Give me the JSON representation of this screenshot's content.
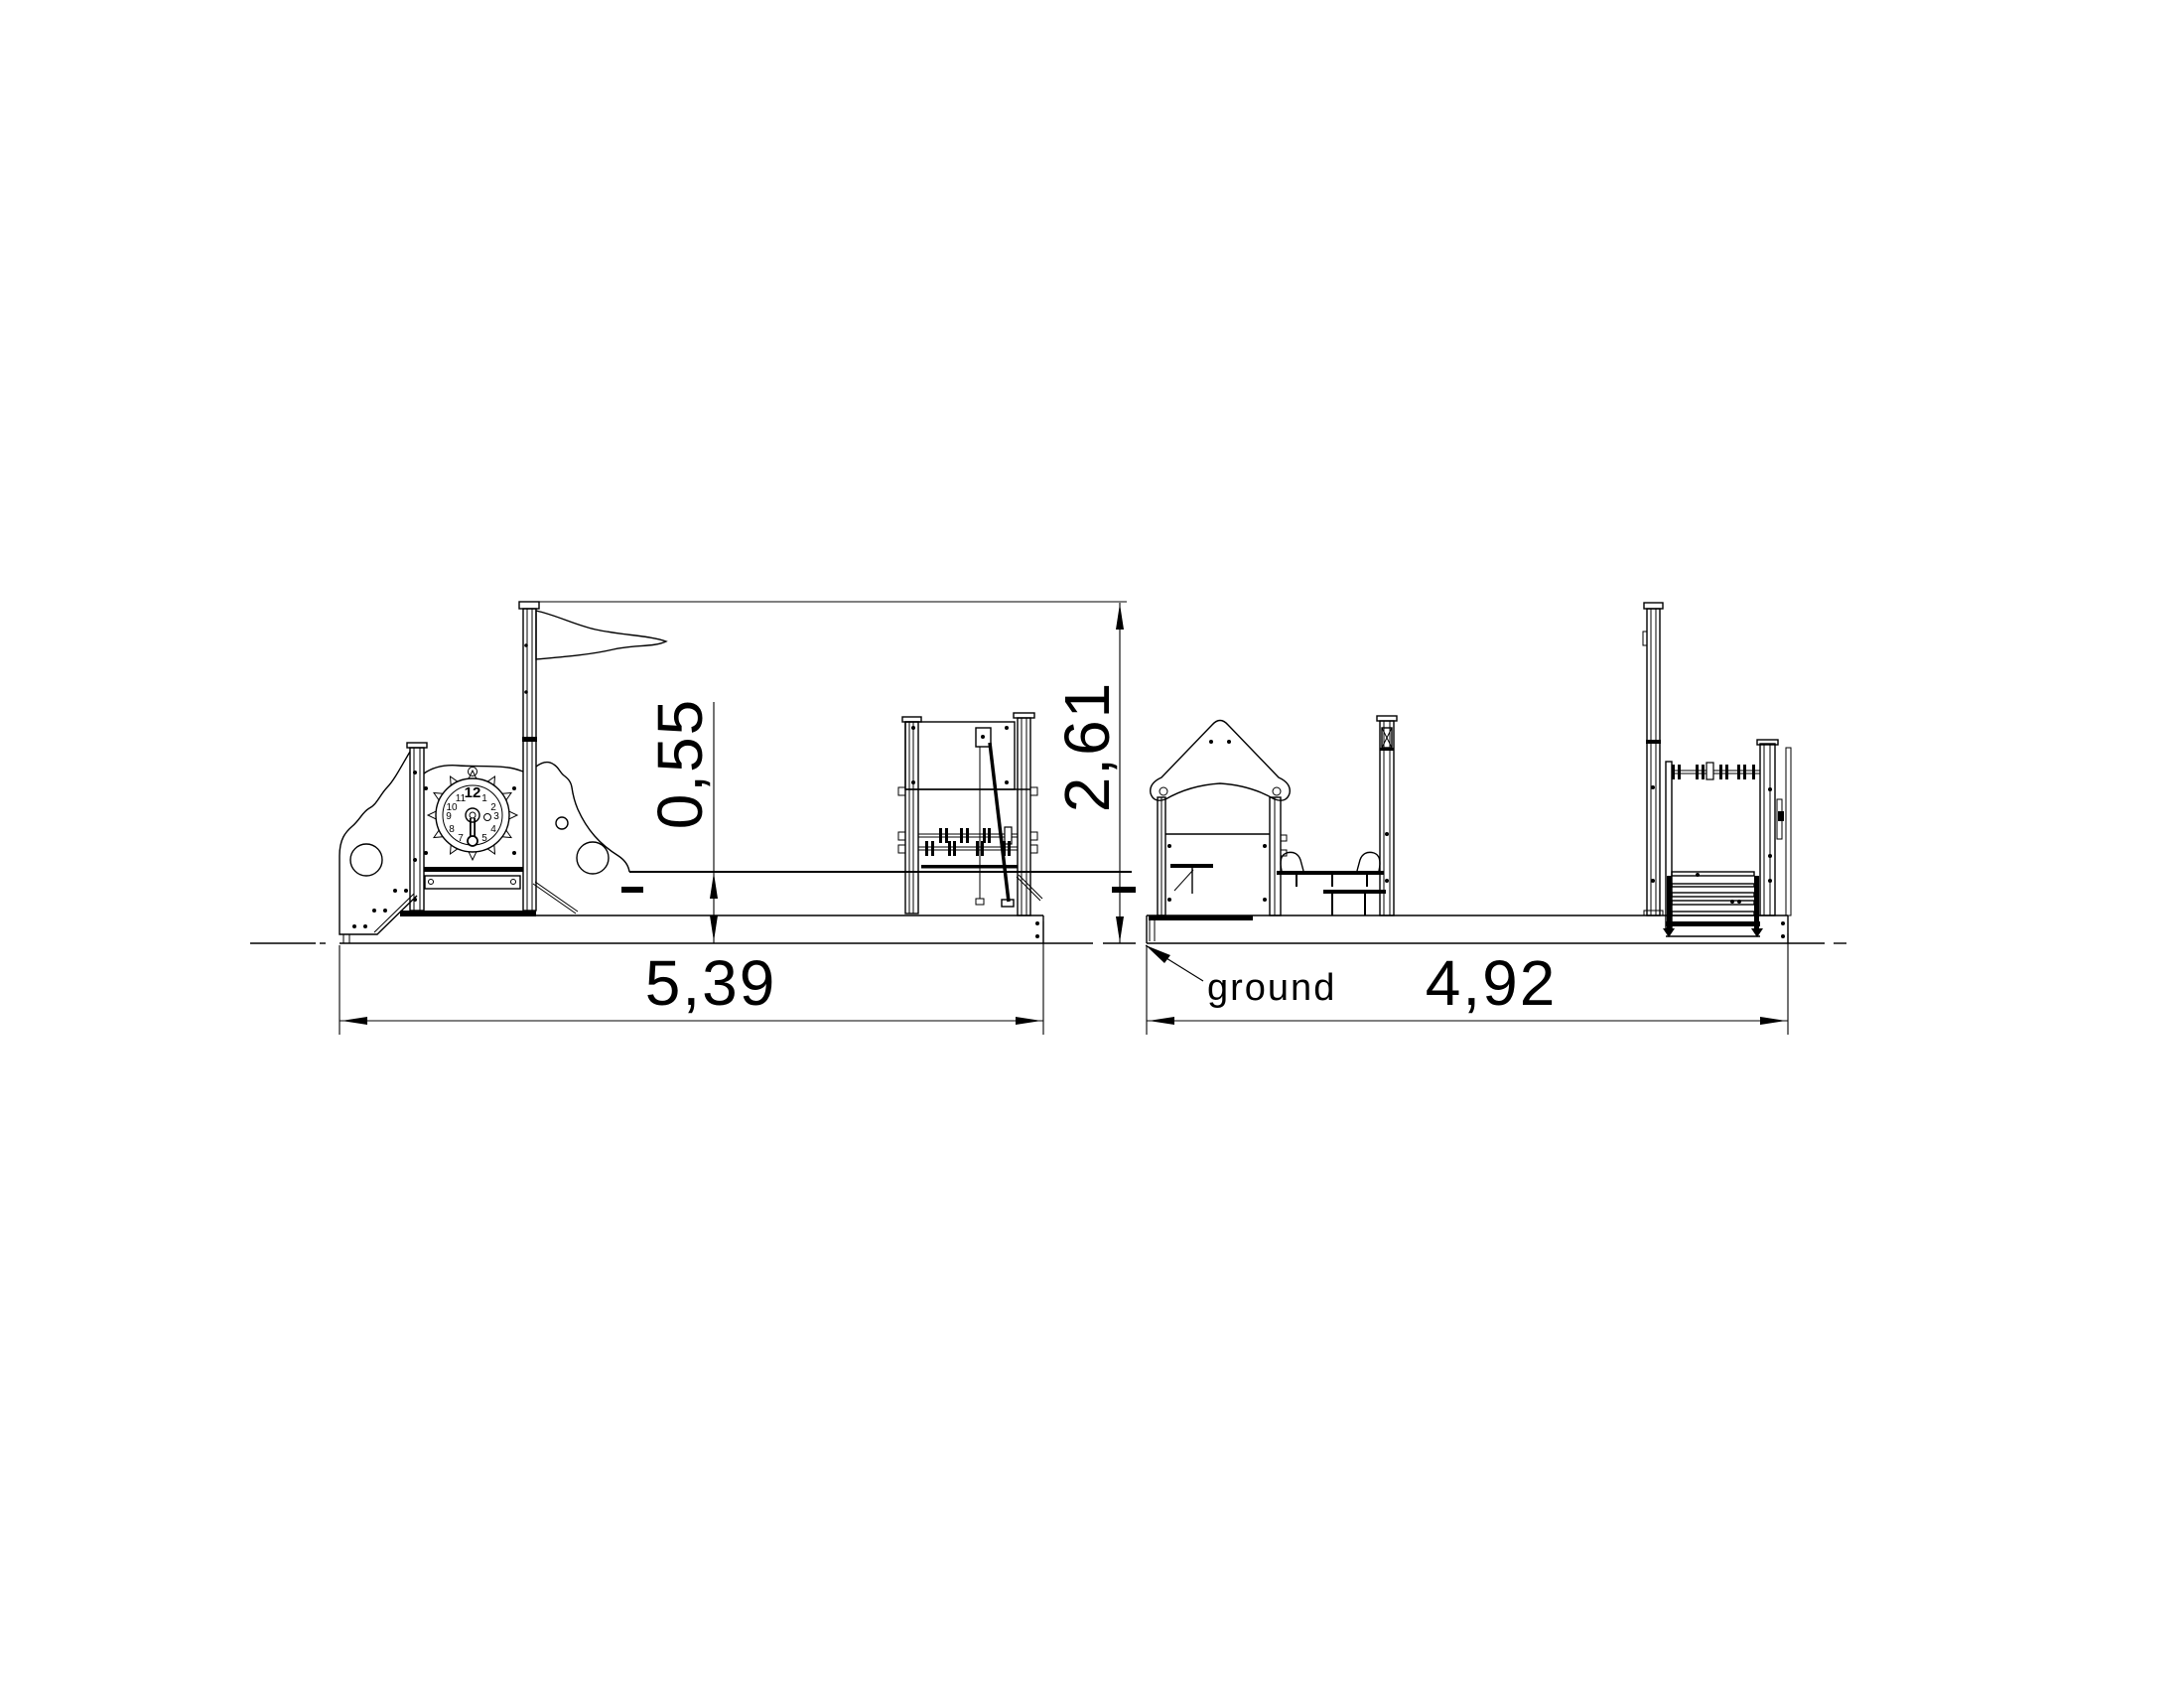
{
  "dimensions": {
    "left_view_width": "5,39",
    "right_view_width": "4,92",
    "total_height": "2,61",
    "deck_height": "0,55"
  },
  "labels": {
    "ground": "ground"
  },
  "clock": {
    "numbers": [
      "12",
      "1",
      "2",
      "3",
      "4",
      "5",
      "6",
      "7",
      "8",
      "9",
      "10",
      "11"
    ]
  },
  "colors": {
    "line": "#000000",
    "background": "#ffffff"
  }
}
